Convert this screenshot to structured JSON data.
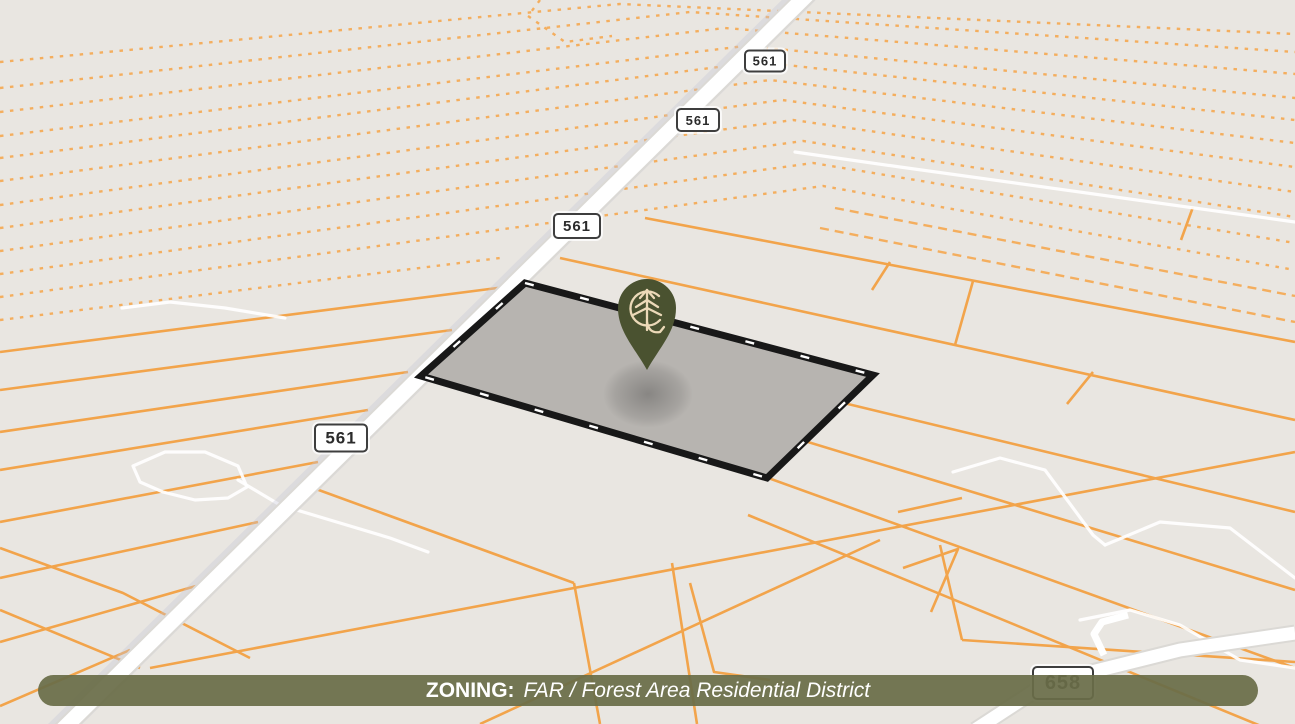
{
  "banner": {
    "label": "ZONING:",
    "value": "FAR / Forest Area Residential District",
    "bg": "rgba(105,109,72,0.93)",
    "text_color": "#ffffff"
  },
  "shields": [
    {
      "label": "561",
      "x": 765,
      "y": 61,
      "w": 38,
      "h": 19,
      "fs": 13
    },
    {
      "label": "561",
      "x": 698,
      "y": 120,
      "w": 40,
      "h": 20,
      "fs": 13
    },
    {
      "label": "561",
      "x": 577,
      "y": 226,
      "w": 44,
      "h": 22,
      "fs": 15
    },
    {
      "label": "561",
      "x": 341,
      "y": 438,
      "w": 50,
      "h": 25,
      "fs": 17
    },
    {
      "label": "658",
      "x": 1063,
      "y": 683,
      "w": 58,
      "h": 30,
      "fs": 20
    }
  ],
  "pin": {
    "logo": "C-arc-pine-tree-L-monogram",
    "body_color": "#4a5230",
    "logo_color": "#ecd9b8"
  },
  "parcel": {
    "points": "525,283 873,375 767,478 421,376",
    "fill": "#b7b4b0",
    "border": "#181818",
    "dash_color": "#ffffff"
  },
  "map": {
    "bg": "#e9e6e1",
    "orange": "#f2a44b",
    "orange_dotted": "#f4ae5e",
    "road_fill": "#ffffff",
    "road_casing": "#dbd9d5",
    "road_shadow": "#c7c5d6",
    "route561": "812,-10 58,734",
    "route658": "975,730 1047,683 1180,650 1295,633",
    "spur658": "1104,655 1094,634 1102,622 1128,615",
    "dotted": [
      "0,62 620,4 1295,34",
      "0,88 690,12 1295,52",
      "0,112 725,28 1295,74",
      "0,136 745,46 1295,98",
      "0,158 758,62 1295,120",
      "0,181 770,80 1295,143",
      "0,205 782,100 1295,167",
      "0,228 793,120 1295,192",
      "0,251 803,141 1295,217",
      "0,274 813,163 1295,243",
      "0,297 823,186 1295,270",
      "0,320 500,258",
      "540,0 528,16 565,42 612,36"
    ],
    "dashed": [
      "835,208 1295,296",
      "820,228 1295,322"
    ],
    "solid": [
      "0,352 505,287",
      "0,390 452,330",
      "0,432 408,372",
      "0,470 368,410",
      "0,522 318,462",
      "0,578 258,522",
      "0,642 196,586",
      "0,706 130,650",
      "0,548 123,593 250,658",
      "0,610 140,668",
      "645,218 1295,342",
      "560,258 1295,420",
      "790,390 1295,512",
      "775,432 1295,590",
      "760,475 1295,668",
      "748,515 1295,740",
      "890,262 872,290",
      "1193,207 1181,240",
      "1093,372 1067,404",
      "973,281 955,345",
      "150,668 1295,452",
      "305,485 574,583",
      "574,583 600,724",
      "672,563 697,724",
      "690,583 714,672 770,680",
      "940,545 962,640",
      "962,640 1295,662",
      "880,540 480,724",
      "898,512 962,498",
      "903,568 958,549 931,612"
    ],
    "trails": [
      "795,152 900,167 1295,222",
      "122,308 170,302 225,308 285,318",
      "133,466 165,452 205,452 238,466 247,487 228,498 195,500 163,492 140,482 133,466",
      "238,480 280,505 330,520 390,538 428,552",
      "953,472 1000,458 1045,470 1093,535 1105,545",
      "1105,545 1160,522 1230,528 1295,578",
      "1080,620 1130,610 1180,625 1240,660 1295,668"
    ]
  }
}
